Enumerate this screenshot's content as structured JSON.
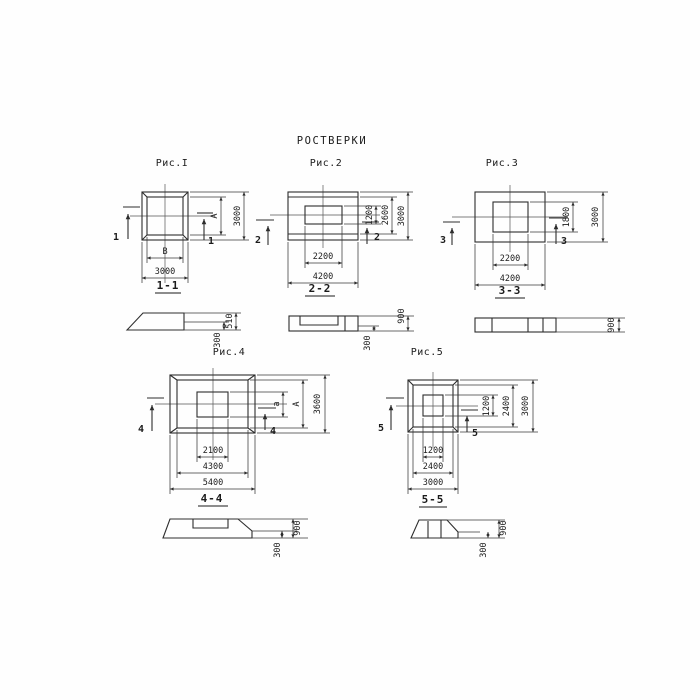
{
  "title": "РОСТВЕРКИ",
  "colors": {
    "ink": "#2d2d2d",
    "paper": "#ffffff"
  },
  "fig1": {
    "label": "Рис.I",
    "cut": "1",
    "dim_inner_w": "В",
    "dim_inner_h": "А",
    "dim_outer_w": "3000",
    "dim_outer_h": "3000",
    "section_label": "1-1",
    "sec_h_edge": "300",
    "sec_h_total": "510"
  },
  "fig2": {
    "label": "Рис.2",
    "cut": "2",
    "dim_inner_w": "2200",
    "dim_outer_w": "4200",
    "dim_inner_h": "1200",
    "dim_mid_h": "2600",
    "dim_outer_h": "3000",
    "section_label": "2-2",
    "sec_h_edge": "300",
    "sec_h_total": "900"
  },
  "fig3": {
    "label": "Рис.3",
    "cut": "3",
    "dim_inner_w": "2200",
    "dim_outer_w": "4200",
    "dim_inner_h": "1800",
    "dim_outer_h": "3000",
    "section_label": "3-3",
    "sec_h_total": "900"
  },
  "fig4": {
    "label": "Рис.4",
    "cut": "4",
    "dim_inner_w": "2100",
    "dim_mid_w": "4300",
    "dim_outer_w": "5400",
    "dim_inner_h": "а",
    "dim_mid_h": "А",
    "dim_outer_h": "3600",
    "section_label": "4-4",
    "sec_h_edge": "300",
    "sec_h_total": "900"
  },
  "fig5": {
    "label": "Рис.5",
    "cut": "5",
    "dim_inner_w": "1200",
    "dim_mid_w": "2400",
    "dim_outer_w": "3000",
    "dim_inner_h": "1200",
    "dim_mid_h": "2400",
    "dim_outer_h": "3000",
    "section_label": "5-5",
    "sec_h_edge": "300",
    "sec_h_total": "900"
  }
}
